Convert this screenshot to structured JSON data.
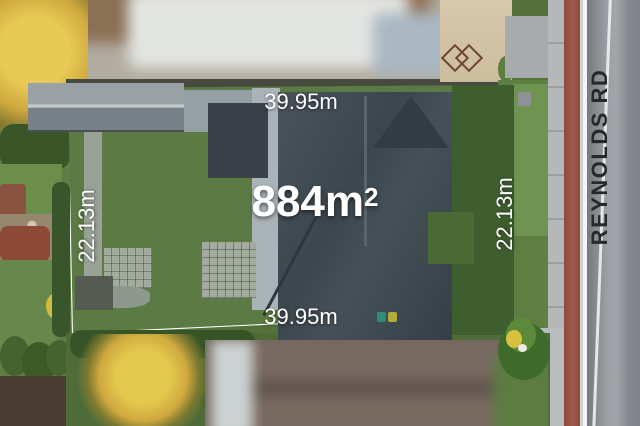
{
  "image_type": "aerial-property-listing-photo",
  "labels": {
    "area_value": "884m",
    "area_sup": "2",
    "frontage_top": "39.95m",
    "frontage_bottom": "39.95m",
    "depth_left": "22.13m",
    "depth_right": "22.13m",
    "street_name": "REYNOLDS RD"
  },
  "colors": {
    "boundary_line": "#ffffff",
    "lot_overlay_tint": "#0a1d38",
    "dimension_text": "#ffffff",
    "street_text": "#26282c",
    "road_surface": "#8b8e92",
    "grass_bright": "#6f9350",
    "house_roof": "#3c464d"
  }
}
